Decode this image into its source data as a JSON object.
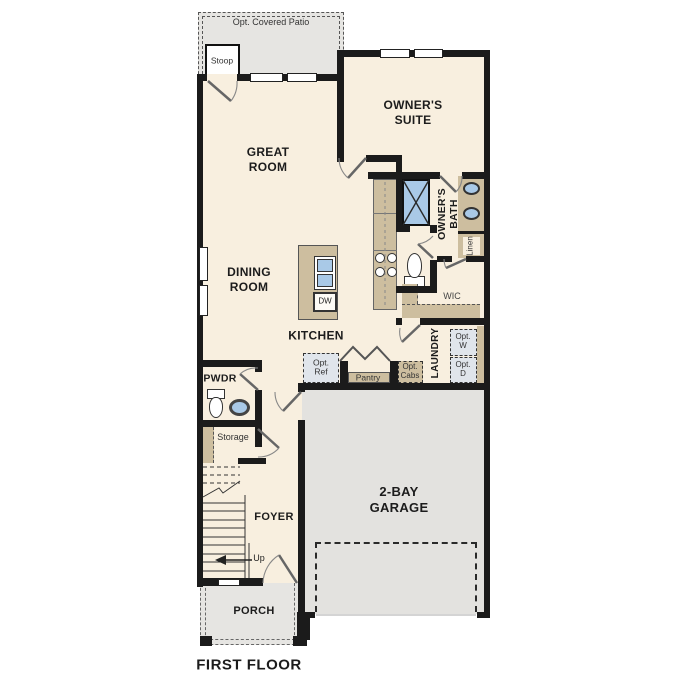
{
  "colors": {
    "wall": "#1b1b1b",
    "cream": "#f8efdf",
    "gray": "#e6e5e2",
    "garage": "#e3e2df",
    "tan": "#cdbe9f",
    "blue": "#a9c9e7",
    "optbox": "#e0e5eb"
  },
  "title": {
    "first_floor": "FIRST FLOOR"
  },
  "outdoor": {
    "patio": "Opt. Covered Patio",
    "stoop": "Stoop"
  },
  "rooms": {
    "great_room": "GREAT\nROOM",
    "owners_suite": "OWNER'S\nSUITE",
    "owners_bath": "OWNER'S\nBATH",
    "linen": "Linen",
    "wic": "WIC",
    "dining_room": "DINING\nROOM",
    "kitchen": "KITCHEN",
    "laundry": "LAUNDRY",
    "pwdr": "PWDR",
    "storage": "Storage",
    "foyer": "FOYER",
    "garage": "2-BAY\nGARAGE",
    "porch": "PORCH"
  },
  "features": {
    "dw": "DW",
    "opt_ref": "Opt.\nRef",
    "pantry": "Pantry",
    "opt_cabs": "Opt.\nCabs",
    "opt_w": "Opt.\nW",
    "opt_d": "Opt.\nD",
    "up": "Up"
  }
}
